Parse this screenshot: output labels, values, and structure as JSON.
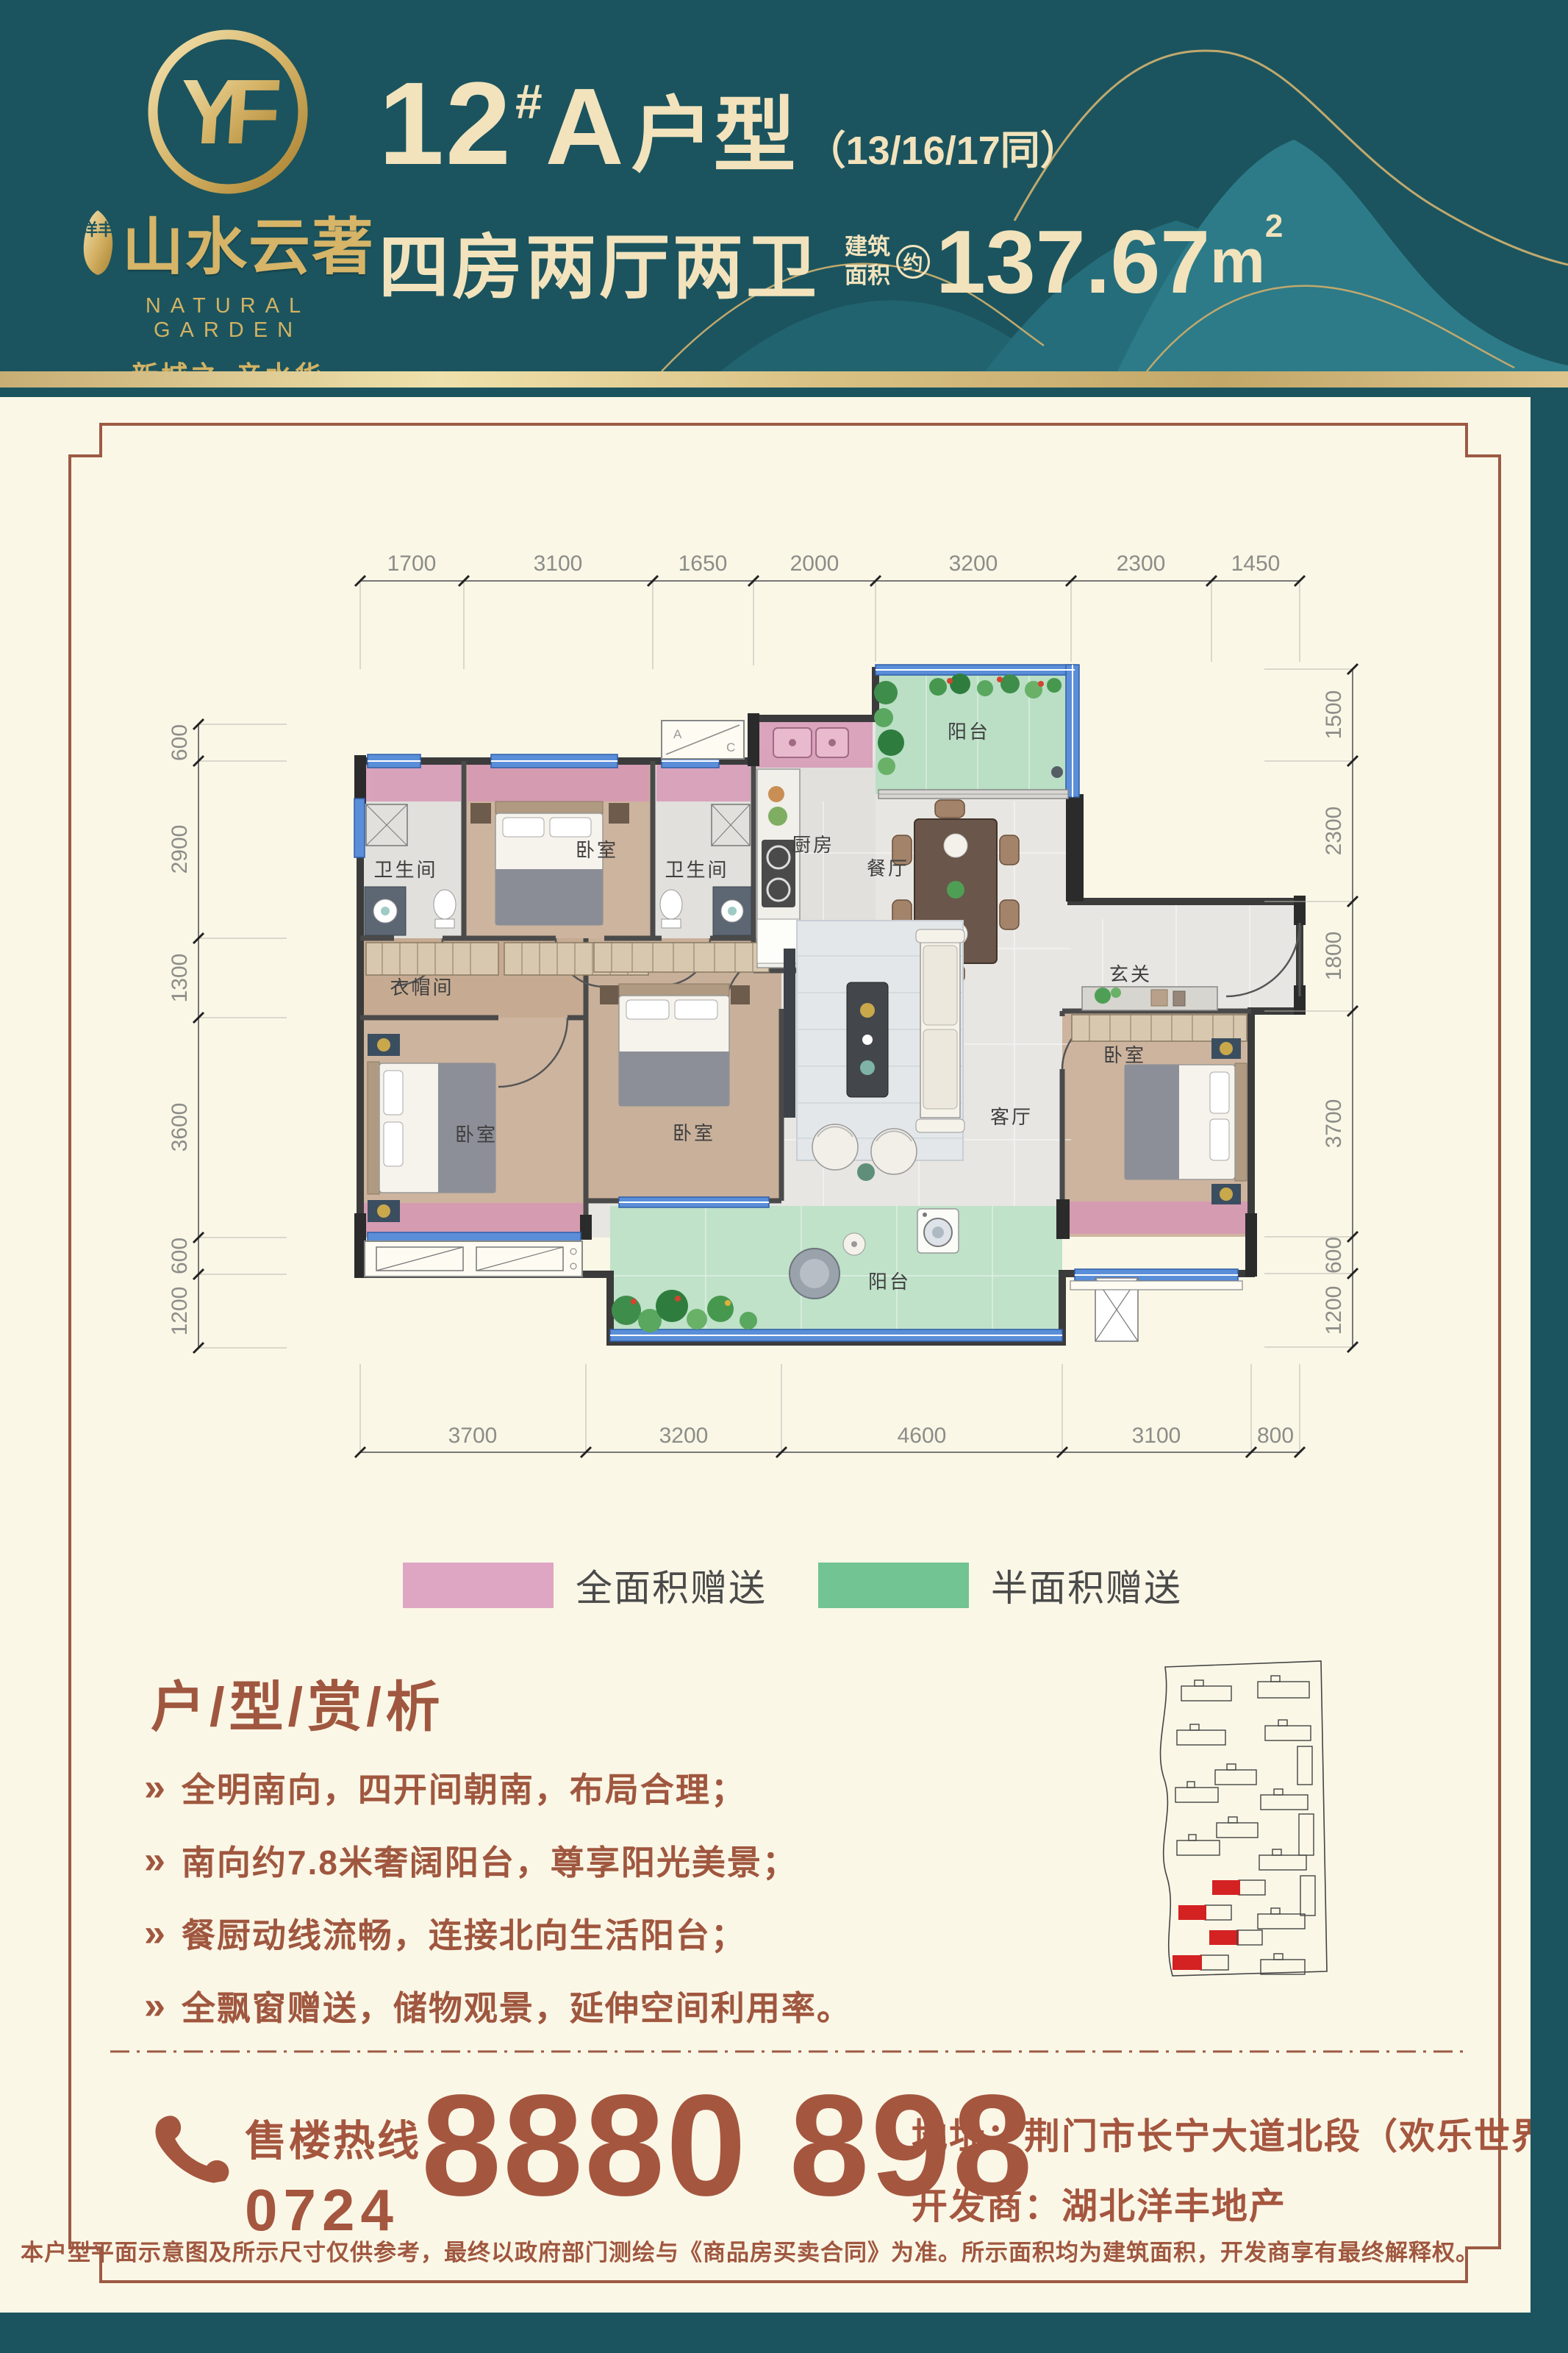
{
  "header": {
    "logo": {
      "monogram": "YF",
      "seal": "洋丰",
      "name": "山水云著",
      "name_en": "NATURAL GARDEN",
      "slogan1": "新城之芯",
      "slogan2": "亲水华宅"
    },
    "title": {
      "number": "12",
      "hash": "#",
      "letter": "A",
      "suffix": "户型",
      "note": "（13/16/17同）"
    },
    "subtitle": {
      "layout": "四房两厅两卫",
      "area_label_1": "建筑",
      "area_label_2": "面积",
      "approx": "约",
      "area_value": "137.67",
      "area_unit": "m",
      "area_sup": "2"
    }
  },
  "plan": {
    "rooms": {
      "bath1": "卫生间",
      "bedroom_n": "卧室",
      "bath2": "卫生间",
      "kitchen": "厨房",
      "balcony_n": "阳台",
      "dining": "餐厅",
      "foyer": "玄关",
      "cloak": "衣帽间",
      "master": "卧室",
      "bedroom2": "卧室",
      "living": "客厅",
      "bedroom3": "卧室",
      "balcony_s": "阳台"
    },
    "dims": {
      "top": [
        "1700",
        "3100",
        "1650",
        "2000",
        "3200",
        "2300",
        "1450"
      ],
      "bottom": [
        "3700",
        "3200",
        "4600",
        "3100",
        "800"
      ],
      "left": [
        "600",
        "2900",
        "1300",
        "3600",
        "600",
        "1200"
      ],
      "right": [
        "1500",
        "2300",
        "1800",
        "3700",
        "600",
        "1200"
      ]
    },
    "ac_a": "A",
    "ac_c": "C"
  },
  "legend": {
    "full": {
      "label": "全面积赠送",
      "color": "#dfa6c3"
    },
    "half": {
      "label": "半面积赠送",
      "color": "#72c492"
    }
  },
  "analysis": {
    "title": "户/型/赏/析",
    "bullets": [
      "全明南向，四开间朝南，布局合理；",
      "南向约7.8米奢阔阳台，尊享阳光美景；",
      "餐厨动线流畅，连接北向生活阳台；",
      "全飘窗赠送，储物观景，延伸空间利用率。"
    ]
  },
  "contact": {
    "hotline_label": "售楼热线",
    "phone_prefix": "0724",
    "phone": "8880 898",
    "address": "地址：荆门市长宁大道北段（欢乐世界南）",
    "developer": "开发商：湖北洋丰地产"
  },
  "disclaimer": "本户型平面示意图及所示尺寸仅供参考，最终以政府部门测绘与《商品房买卖合同》为准。所示面积均为建筑面积，开发商享有最终解释权。",
  "colors": {
    "header_teal": "#1b545e",
    "accent_brown": "#a0573f",
    "gift_full_pink": "#d795b4",
    "gift_half_green": "#badfc5",
    "window_blue": "#5a8ed8",
    "gold": "#d6b468"
  }
}
